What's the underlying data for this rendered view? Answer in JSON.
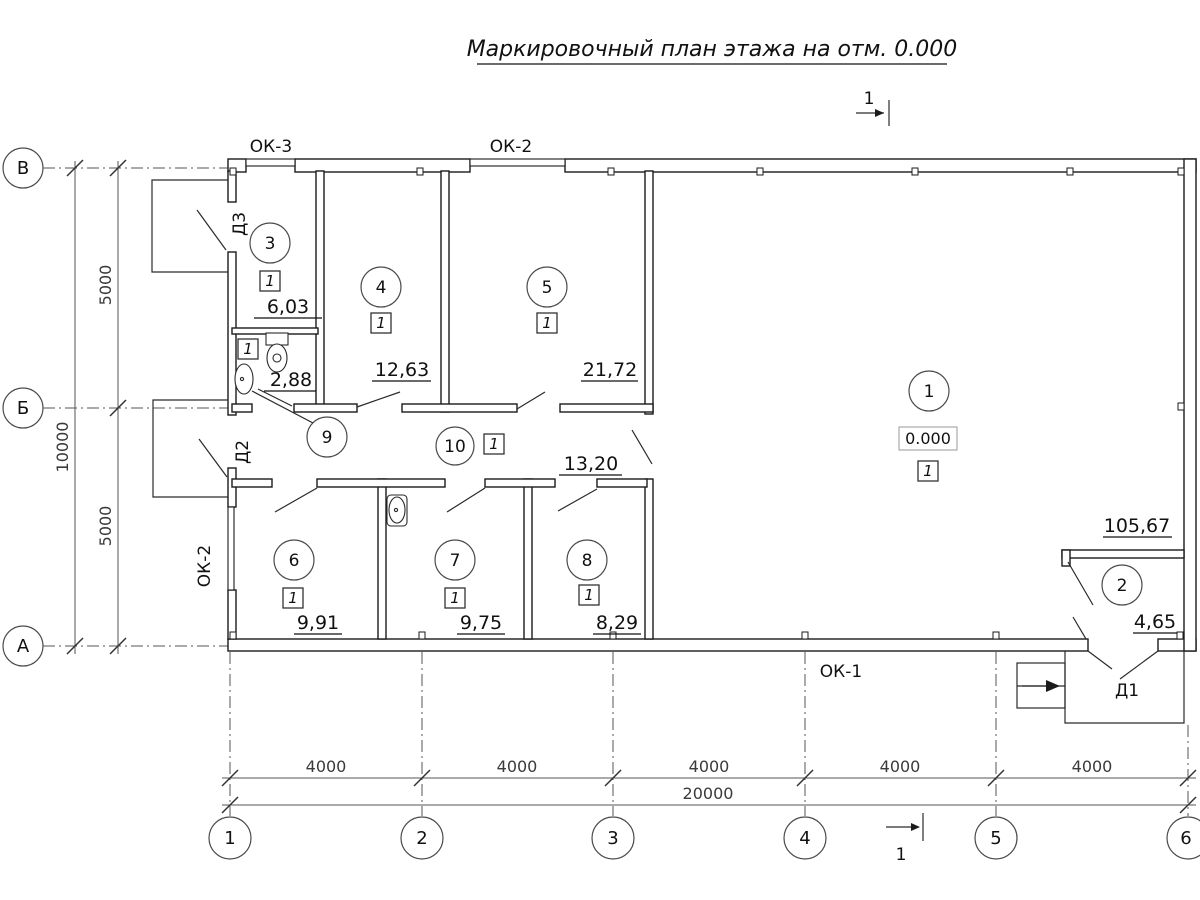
{
  "title": "Маркировочный план этажа на отм. 0.000",
  "section_mark": {
    "top": "1",
    "bottom": "1"
  },
  "axes": {
    "rows": [
      {
        "label": "В"
      },
      {
        "label": "Б"
      },
      {
        "label": "А"
      }
    ],
    "cols": [
      {
        "label": "1"
      },
      {
        "label": "2"
      },
      {
        "label": "3"
      },
      {
        "label": "4"
      },
      {
        "label": "5"
      },
      {
        "label": "6"
      }
    ]
  },
  "dims": {
    "v_segment_top": "5000",
    "v_segment_bottom": "5000",
    "v_total": "10000",
    "h_segments": [
      "4000",
      "4000",
      "4000",
      "4000",
      "4000"
    ],
    "h_total": "20000"
  },
  "windows": {
    "ok3_top": "ОК-3",
    "ok2_top": "ОК-2",
    "ok2_left": "ОК-2",
    "ok1_bottom": "ОК-1"
  },
  "doors": {
    "d3": "Д3",
    "d2": "Д2",
    "d1": "Д1"
  },
  "elevation": "0.000",
  "rooms": {
    "r1": {
      "num": "1",
      "area": "105,67",
      "finish": "1"
    },
    "r2": {
      "num": "2",
      "area": "4,65"
    },
    "r3": {
      "num": "3",
      "area": "6,03",
      "finish": "1"
    },
    "r4": {
      "num": "4",
      "area": "12,63",
      "finish": "1"
    },
    "r5": {
      "num": "5",
      "area": "21,72",
      "finish": "1"
    },
    "r6": {
      "num": "6",
      "area": "9,91",
      "finish": "1"
    },
    "r7": {
      "num": "7",
      "area": "9,75",
      "finish": "1"
    },
    "r8": {
      "num": "8",
      "area": "8,29",
      "finish": "1"
    },
    "r9": {
      "num": "9",
      "area": "2,88",
      "finish": "1"
    },
    "r10": {
      "num": "10",
      "area": "13,20",
      "finish": "1"
    }
  }
}
